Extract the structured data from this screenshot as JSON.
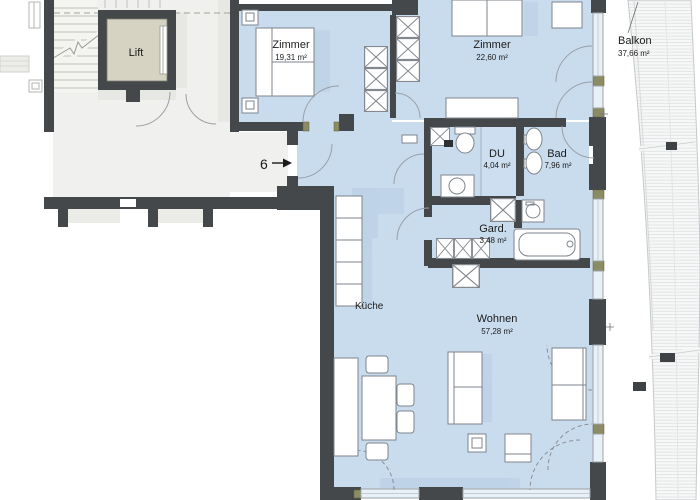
{
  "plan": {
    "title": "apartment-floor-plan",
    "unit": {
      "number": "6"
    },
    "rooms": {
      "lift": {
        "name": "Lift"
      },
      "zimmer1": {
        "name": "Zimmer",
        "area": "19,31 m²"
      },
      "zimmer2": {
        "name": "Zimmer",
        "area": "22,60 m²"
      },
      "balkon": {
        "name": "Balkon",
        "area": "37,66 m²"
      },
      "du": {
        "name": "DU",
        "area": "4,04 m²"
      },
      "bad": {
        "name": "Bad",
        "area": "7,96 m²"
      },
      "gard": {
        "name": "Gard.",
        "area": "3,48 m²"
      },
      "kueche": {
        "name": "Küche"
      },
      "wohnen": {
        "name": "Wohnen",
        "area": "57,28 m²"
      }
    },
    "colors": {
      "wall": "#45484b",
      "floor": "#c9dcee",
      "floor_shadow": "#b5cbe2",
      "corridor": "#f0f0ee",
      "lift_cabin": "#d6d3c3",
      "window_joint": "#8c8c64",
      "glass": "#e9f1f8",
      "deck_line": "#dddfe0"
    }
  }
}
